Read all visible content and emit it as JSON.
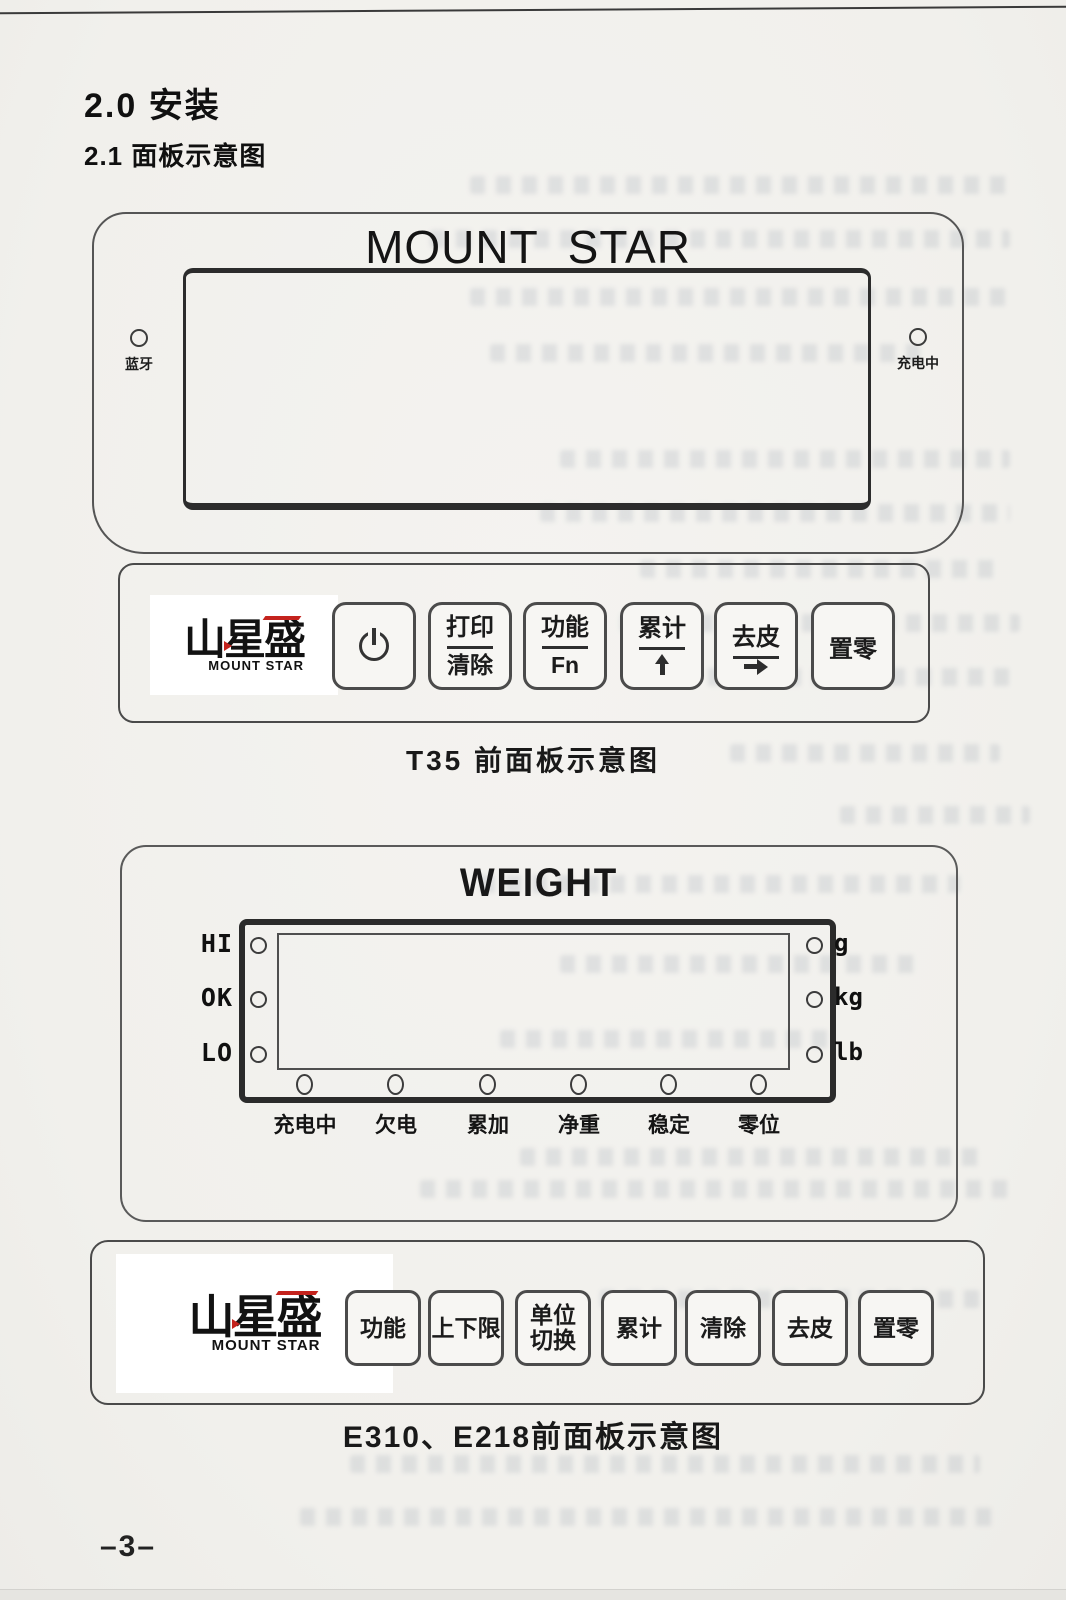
{
  "page": {
    "section_title": "2.0 安装",
    "subsection_title": "2.1 面板示意图",
    "page_number": "–3–"
  },
  "display_panel": {
    "brand": "MOUNT STAR",
    "bluetooth_label": "蓝牙",
    "charging_label": "充电中"
  },
  "t35_keypad": {
    "logo_cn": "山星盛",
    "logo_en": "MOUNT STAR",
    "buttons": {
      "power": {
        "icon": "power-icon"
      },
      "print_clear": {
        "top": "打印",
        "bottom": "清除"
      },
      "function": {
        "top": "功能",
        "bottom": "Fn"
      },
      "accumulate": {
        "top": "累计",
        "icon": "up-arrow-icon"
      },
      "tare": {
        "top": "去皮",
        "icon": "right-arrow-icon"
      },
      "zero": {
        "label": "置零"
      }
    },
    "caption": "T35 前面板示意图"
  },
  "weight_panel": {
    "title": "WEIGHT",
    "left_indicators": [
      {
        "label": "HI"
      },
      {
        "label": "OK"
      },
      {
        "label": "LO"
      }
    ],
    "unit_indicators": [
      {
        "label": "g"
      },
      {
        "label": "kg"
      },
      {
        "label": "lb"
      }
    ],
    "status_indicators": [
      {
        "label": "充电中"
      },
      {
        "label": "欠电"
      },
      {
        "label": "累加"
      },
      {
        "label": "净重"
      },
      {
        "label": "稳定"
      },
      {
        "label": "零位"
      }
    ]
  },
  "e310_keypad": {
    "logo_cn": "山星盛",
    "logo_en": "MOUNT STAR",
    "buttons": [
      {
        "label": "功能"
      },
      {
        "label": "上下限"
      },
      {
        "label": "单位\n切换"
      },
      {
        "label": "累计"
      },
      {
        "label": "清除"
      },
      {
        "label": "去皮"
      },
      {
        "label": "置零"
      }
    ],
    "caption": "E310、E218前面板示意图"
  },
  "colors": {
    "paper": "#f3f2ee",
    "ink": "#1c1c1c",
    "panel_border": "#4a4a4a",
    "logo_accent_red": "#c4231d"
  }
}
